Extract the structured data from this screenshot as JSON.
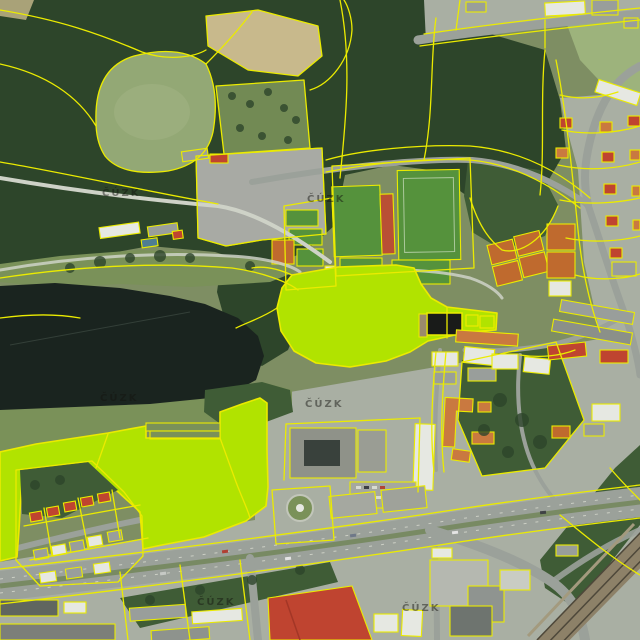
{
  "map": {
    "watermark_text": "ČÚZK",
    "watermark_count": 6,
    "highlighted_parcels": {
      "count": 2,
      "fill": "#b1e300"
    },
    "colors": {
      "parcel": "#ebeb00",
      "highlight": "#b1e300",
      "water": "#1a241f",
      "forest_dark": "#2d452a",
      "forest_mid": "#3f5c36",
      "meadow": "#93a875",
      "park_grass": "#7a9159",
      "field_tan": "#c8b98c",
      "urban_ground": "#a9afa3",
      "road": "#9ba19a",
      "road_light": "#ced2c7",
      "pitch_green": "#55923c",
      "clay_orange": "#bf6a2e",
      "track_red": "#b94f35",
      "roof_red": "#bf4430",
      "roof_orange": "#c97940",
      "roof_white": "#e6e8e2",
      "roof_gray": "#999e9b",
      "roof_dark": "#60665f",
      "building_black": "#191b19",
      "rail_band": "#8d8168",
      "rail_line": "#4e483a"
    }
  }
}
